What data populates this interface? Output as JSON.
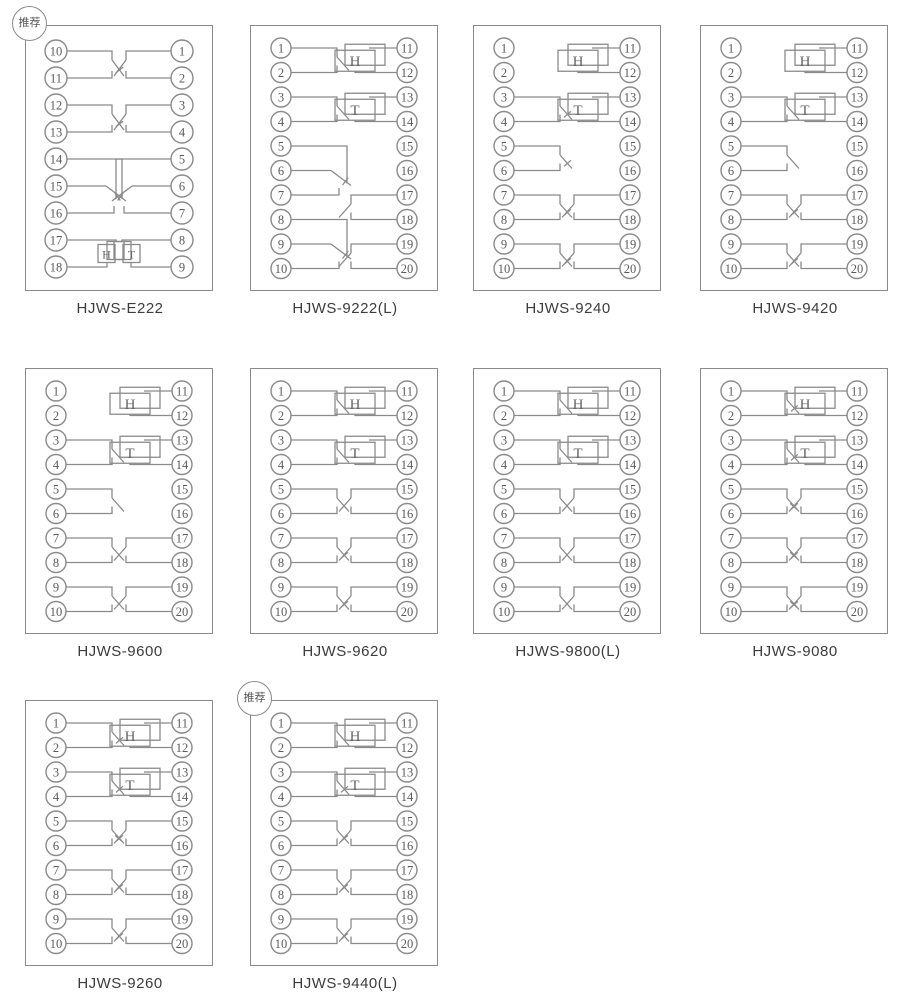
{
  "badge_label": "推荐",
  "colors": {
    "line": "#8a8a8a",
    "terminal_text": "#5a5a5a",
    "box_letter": "#666666",
    "title_text": "#3c3c3c",
    "background": "#ffffff"
  },
  "diagrams": [
    {
      "title": "HJWS-E222",
      "recommended": true,
      "left_terminals": [
        10,
        11,
        12,
        13,
        14,
        15,
        16,
        17,
        18
      ],
      "right_terminals": [
        1,
        2,
        3,
        4,
        5,
        6,
        7,
        8,
        9
      ],
      "elements": [
        {
          "side": "left",
          "type": "contact-nc",
          "terminals": [
            10,
            11
          ]
        },
        {
          "side": "left",
          "type": "contact-nc",
          "terminals": [
            12,
            13
          ]
        },
        {
          "side": "left",
          "type": "changeover",
          "terminals": [
            14,
            15,
            16
          ]
        },
        {
          "side": "left",
          "type": "signal-box-small",
          "label": "H",
          "terminals": [
            17,
            18
          ]
        },
        {
          "side": "right",
          "type": "contact-no",
          "terminals": [
            1,
            2
          ]
        },
        {
          "side": "right",
          "type": "contact-no",
          "terminals": [
            3,
            4
          ]
        },
        {
          "side": "right",
          "type": "changeover",
          "terminals": [
            5,
            6,
            7
          ]
        },
        {
          "side": "right",
          "type": "signal-box-small",
          "label": "T",
          "terminals": [
            8,
            9
          ]
        }
      ]
    },
    {
      "title": "HJWS-9222(L)",
      "recommended": false,
      "left_terminals": [
        1,
        2,
        3,
        4,
        5,
        6,
        7,
        8,
        9,
        10
      ],
      "right_terminals": [
        11,
        12,
        13,
        14,
        15,
        16,
        17,
        18,
        19,
        20
      ],
      "elements": [
        {
          "side": "left",
          "type": "contact-no",
          "terminals": [
            1,
            2
          ]
        },
        {
          "side": "left",
          "type": "contact-no",
          "terminals": [
            3,
            4
          ]
        },
        {
          "side": "left",
          "type": "changeover",
          "terminals": [
            5,
            6,
            7
          ]
        },
        {
          "side": "left",
          "type": "changeover",
          "terminals": [
            8,
            9,
            10
          ]
        },
        {
          "side": "right",
          "type": "signal-box",
          "label": "H",
          "terminals": [
            11,
            12
          ]
        },
        {
          "side": "right",
          "type": "signal-box",
          "label": "T",
          "terminals": [
            13,
            14
          ]
        },
        {
          "side": "right",
          "type": "contact-no",
          "terminals": [
            17,
            18
          ]
        },
        {
          "side": "right",
          "type": "contact-no",
          "terminals": [
            19,
            20
          ]
        }
      ]
    },
    {
      "title": "HJWS-9240",
      "recommended": false,
      "left_terminals": [
        1,
        2,
        3,
        4,
        5,
        6,
        7,
        8,
        9,
        10
      ],
      "right_terminals": [
        11,
        12,
        13,
        14,
        15,
        16,
        17,
        18,
        19,
        20
      ],
      "elements": [
        {
          "side": "left",
          "type": "contact-nc",
          "terminals": [
            3,
            4
          ]
        },
        {
          "side": "left",
          "type": "contact-nc",
          "terminals": [
            5,
            6
          ]
        },
        {
          "side": "left",
          "type": "contact-nc",
          "terminals": [
            7,
            8
          ]
        },
        {
          "side": "left",
          "type": "contact-nc",
          "terminals": [
            9,
            10
          ]
        },
        {
          "side": "right",
          "type": "signal-box",
          "label": "H",
          "terminals": [
            11,
            12
          ]
        },
        {
          "side": "right",
          "type": "signal-box",
          "label": "T",
          "terminals": [
            13,
            14
          ]
        },
        {
          "side": "right",
          "type": "contact-no",
          "terminals": [
            17,
            18
          ]
        },
        {
          "side": "right",
          "type": "contact-no",
          "terminals": [
            19,
            20
          ]
        }
      ]
    },
    {
      "title": "HJWS-9420",
      "recommended": false,
      "left_terminals": [
        1,
        2,
        3,
        4,
        5,
        6,
        7,
        8,
        9,
        10
      ],
      "right_terminals": [
        11,
        12,
        13,
        14,
        15,
        16,
        17,
        18,
        19,
        20
      ],
      "elements": [
        {
          "side": "left",
          "type": "contact-no",
          "terminals": [
            3,
            4
          ]
        },
        {
          "side": "left",
          "type": "contact-no",
          "terminals": [
            5,
            6
          ]
        },
        {
          "side": "left",
          "type": "contact-nc",
          "terminals": [
            7,
            8
          ]
        },
        {
          "side": "left",
          "type": "contact-nc",
          "terminals": [
            9,
            10
          ]
        },
        {
          "side": "right",
          "type": "signal-box",
          "label": "H",
          "terminals": [
            11,
            12
          ]
        },
        {
          "side": "right",
          "type": "signal-box",
          "label": "T",
          "terminals": [
            13,
            14
          ]
        },
        {
          "side": "right",
          "type": "contact-no",
          "terminals": [
            17,
            18
          ]
        },
        {
          "side": "right",
          "type": "contact-no",
          "terminals": [
            19,
            20
          ]
        }
      ]
    },
    {
      "title": "HJWS-9600",
      "recommended": false,
      "left_terminals": [
        1,
        2,
        3,
        4,
        5,
        6,
        7,
        8,
        9,
        10
      ],
      "right_terminals": [
        11,
        12,
        13,
        14,
        15,
        16,
        17,
        18,
        19,
        20
      ],
      "elements": [
        {
          "side": "left",
          "type": "contact-no",
          "terminals": [
            3,
            4
          ]
        },
        {
          "side": "left",
          "type": "contact-no",
          "terminals": [
            5,
            6
          ]
        },
        {
          "side": "left",
          "type": "contact-no",
          "terminals": [
            7,
            8
          ]
        },
        {
          "side": "left",
          "type": "contact-no",
          "terminals": [
            9,
            10
          ]
        },
        {
          "side": "right",
          "type": "signal-box",
          "label": "H",
          "terminals": [
            11,
            12
          ]
        },
        {
          "side": "right",
          "type": "signal-box",
          "label": "T",
          "terminals": [
            13,
            14
          ]
        },
        {
          "side": "right",
          "type": "contact-no",
          "terminals": [
            17,
            18
          ]
        },
        {
          "side": "right",
          "type": "contact-no",
          "terminals": [
            19,
            20
          ]
        }
      ]
    },
    {
      "title": "HJWS-9620",
      "recommended": false,
      "left_terminals": [
        1,
        2,
        3,
        4,
        5,
        6,
        7,
        8,
        9,
        10
      ],
      "right_terminals": [
        11,
        12,
        13,
        14,
        15,
        16,
        17,
        18,
        19,
        20
      ],
      "elements": [
        {
          "side": "left",
          "type": "contact-no",
          "terminals": [
            1,
            2
          ]
        },
        {
          "side": "left",
          "type": "contact-no",
          "terminals": [
            3,
            4
          ]
        },
        {
          "side": "left",
          "type": "contact-no",
          "terminals": [
            5,
            6
          ]
        },
        {
          "side": "left",
          "type": "contact-nc",
          "terminals": [
            7,
            8
          ]
        },
        {
          "side": "left",
          "type": "contact-nc",
          "terminals": [
            9,
            10
          ]
        },
        {
          "side": "right",
          "type": "signal-box",
          "label": "H",
          "terminals": [
            11,
            12
          ]
        },
        {
          "side": "right",
          "type": "signal-box",
          "label": "T",
          "terminals": [
            13,
            14
          ]
        },
        {
          "side": "right",
          "type": "contact-no",
          "terminals": [
            15,
            16
          ]
        },
        {
          "side": "right",
          "type": "contact-no",
          "terminals": [
            17,
            18
          ]
        },
        {
          "side": "right",
          "type": "contact-no",
          "terminals": [
            19,
            20
          ]
        }
      ]
    },
    {
      "title": "HJWS-9800(L)",
      "recommended": false,
      "left_terminals": [
        1,
        2,
        3,
        4,
        5,
        6,
        7,
        8,
        9,
        10
      ],
      "right_terminals": [
        11,
        12,
        13,
        14,
        15,
        16,
        17,
        18,
        19,
        20
      ],
      "elements": [
        {
          "side": "left",
          "type": "contact-no",
          "terminals": [
            1,
            2
          ]
        },
        {
          "side": "left",
          "type": "contact-no",
          "terminals": [
            3,
            4
          ]
        },
        {
          "side": "left",
          "type": "contact-no",
          "terminals": [
            5,
            6
          ]
        },
        {
          "side": "left",
          "type": "contact-no",
          "terminals": [
            7,
            8
          ]
        },
        {
          "side": "left",
          "type": "contact-no",
          "terminals": [
            9,
            10
          ]
        },
        {
          "side": "right",
          "type": "signal-box",
          "label": "H",
          "terminals": [
            11,
            12
          ]
        },
        {
          "side": "right",
          "type": "signal-box",
          "label": "T",
          "terminals": [
            13,
            14
          ]
        },
        {
          "side": "right",
          "type": "contact-no",
          "terminals": [
            15,
            16
          ]
        },
        {
          "side": "right",
          "type": "contact-no",
          "terminals": [
            17,
            18
          ]
        },
        {
          "side": "right",
          "type": "contact-no",
          "terminals": [
            19,
            20
          ]
        }
      ]
    },
    {
      "title": "HJWS-9080",
      "recommended": false,
      "left_terminals": [
        1,
        2,
        3,
        4,
        5,
        6,
        7,
        8,
        9,
        10
      ],
      "right_terminals": [
        11,
        12,
        13,
        14,
        15,
        16,
        17,
        18,
        19,
        20
      ],
      "elements": [
        {
          "side": "left",
          "type": "contact-nc",
          "terminals": [
            1,
            2
          ]
        },
        {
          "side": "left",
          "type": "contact-nc",
          "terminals": [
            3,
            4
          ]
        },
        {
          "side": "left",
          "type": "contact-nc",
          "terminals": [
            5,
            6
          ]
        },
        {
          "side": "left",
          "type": "contact-nc",
          "terminals": [
            7,
            8
          ]
        },
        {
          "side": "left",
          "type": "contact-nc",
          "terminals": [
            9,
            10
          ]
        },
        {
          "side": "right",
          "type": "signal-box",
          "label": "H",
          "terminals": [
            11,
            12
          ]
        },
        {
          "side": "right",
          "type": "signal-box",
          "label": "T",
          "terminals": [
            13,
            14
          ]
        },
        {
          "side": "right",
          "type": "contact-nc",
          "terminals": [
            15,
            16
          ]
        },
        {
          "side": "right",
          "type": "contact-nc",
          "terminals": [
            17,
            18
          ]
        },
        {
          "side": "right",
          "type": "contact-nc",
          "terminals": [
            19,
            20
          ]
        }
      ]
    },
    {
      "title": "HJWS-9260",
      "recommended": false,
      "left_terminals": [
        1,
        2,
        3,
        4,
        5,
        6,
        7,
        8,
        9,
        10
      ],
      "right_terminals": [
        11,
        12,
        13,
        14,
        15,
        16,
        17,
        18,
        19,
        20
      ],
      "elements": [
        {
          "side": "left",
          "type": "contact-nc",
          "terminals": [
            1,
            2
          ]
        },
        {
          "side": "left",
          "type": "contact-nc",
          "terminals": [
            3,
            4
          ]
        },
        {
          "side": "left",
          "type": "contact-nc",
          "terminals": [
            5,
            6
          ]
        },
        {
          "side": "left",
          "type": "contact-nc",
          "terminals": [
            7,
            8
          ]
        },
        {
          "side": "left",
          "type": "contact-nc",
          "terminals": [
            9,
            10
          ]
        },
        {
          "side": "right",
          "type": "signal-box",
          "label": "H",
          "terminals": [
            11,
            12
          ]
        },
        {
          "side": "right",
          "type": "signal-box",
          "label": "T",
          "terminals": [
            13,
            14
          ]
        },
        {
          "side": "right",
          "type": "contact-nc",
          "terminals": [
            15,
            16
          ]
        },
        {
          "side": "right",
          "type": "contact-no",
          "terminals": [
            17,
            18
          ]
        },
        {
          "side": "right",
          "type": "contact-no",
          "terminals": [
            19,
            20
          ]
        }
      ]
    },
    {
      "title": "HJWS-9440(L)",
      "recommended": true,
      "left_terminals": [
        1,
        2,
        3,
        4,
        5,
        6,
        7,
        8,
        9,
        10
      ],
      "right_terminals": [
        11,
        12,
        13,
        14,
        15,
        16,
        17,
        18,
        19,
        20
      ],
      "elements": [
        {
          "side": "left",
          "type": "contact-no",
          "terminals": [
            1,
            2
          ]
        },
        {
          "side": "left",
          "type": "contact-nc",
          "terminals": [
            3,
            4
          ]
        },
        {
          "side": "left",
          "type": "contact-nc",
          "terminals": [
            5,
            6
          ]
        },
        {
          "side": "left",
          "type": "contact-nc",
          "terminals": [
            7,
            8
          ]
        },
        {
          "side": "left",
          "type": "contact-nc",
          "terminals": [
            9,
            10
          ]
        },
        {
          "side": "right",
          "type": "signal-box",
          "label": "H",
          "terminals": [
            11,
            12
          ]
        },
        {
          "side": "right",
          "type": "signal-box",
          "label": "T",
          "terminals": [
            13,
            14
          ]
        },
        {
          "side": "right",
          "type": "contact-no",
          "terminals": [
            15,
            16
          ]
        },
        {
          "side": "right",
          "type": "contact-no",
          "terminals": [
            17,
            18
          ]
        },
        {
          "side": "right",
          "type": "contact-no",
          "terminals": [
            19,
            20
          ]
        }
      ]
    }
  ]
}
